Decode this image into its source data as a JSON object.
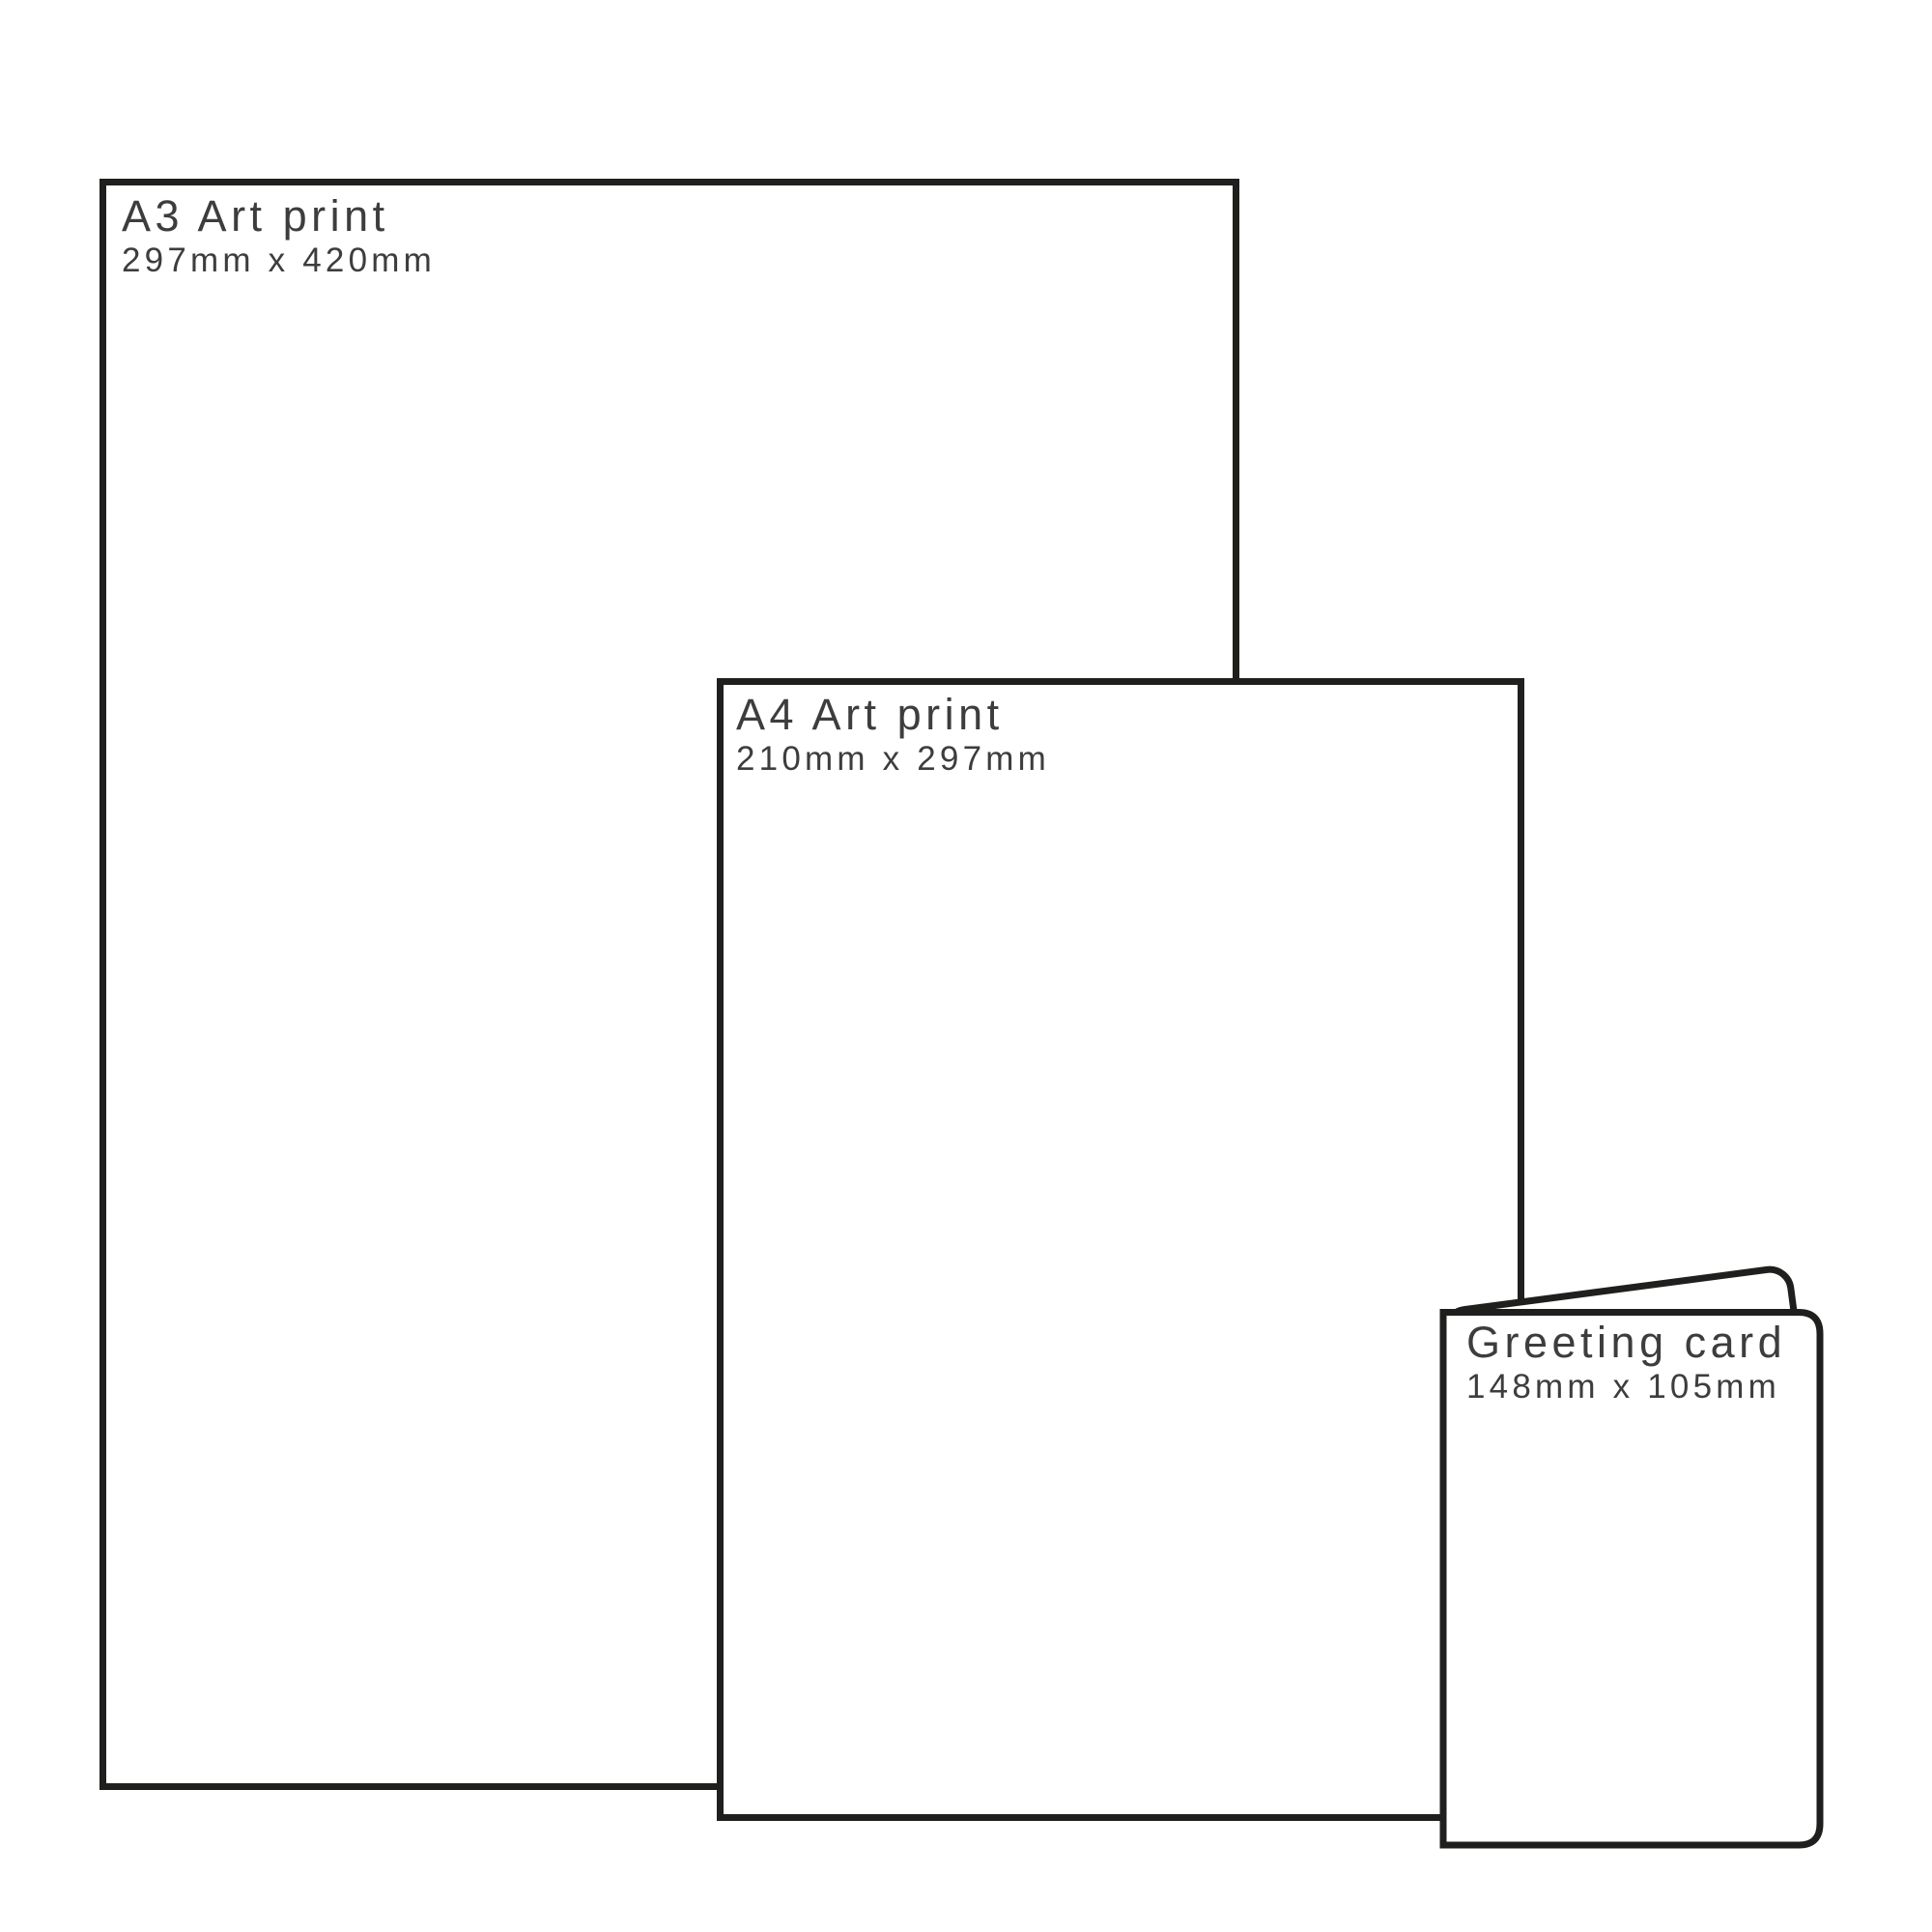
{
  "diagram": {
    "type": "print-size-comparison",
    "background_color": "#ffffff",
    "outline_color": "#1f1f1d",
    "label_color": "#3d3d3d",
    "items": [
      {
        "name": "a3-art-print",
        "title": "A3 Art print",
        "dimensions": "297mm x 420mm"
      },
      {
        "name": "a4-art-print",
        "title": "A4 Art print",
        "dimensions": "210mm x 297mm"
      },
      {
        "name": "greeting-card",
        "title": "Greeting card",
        "dimensions": "148mm x 105mm"
      }
    ]
  }
}
